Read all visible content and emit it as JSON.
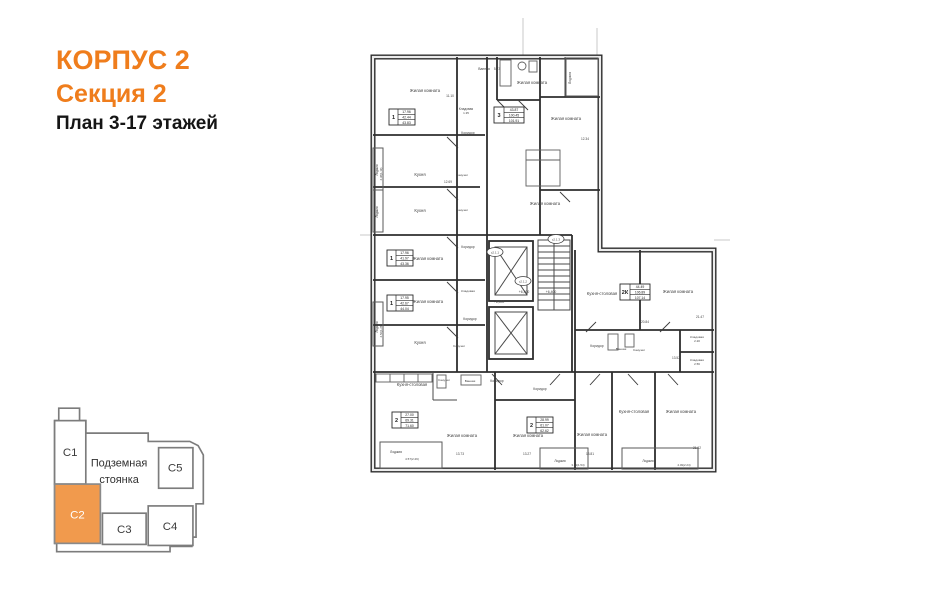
{
  "header": {
    "line1": "КОРПУС 2",
    "line2": "Секция 2",
    "line3": "План 3-17 этажей"
  },
  "colors": {
    "accent_orange": "#EF7D1C",
    "minimap_highlight": "#F19A4D",
    "plan_ink": "#2e2e2e",
    "label_ink": "#3f3f3f"
  },
  "minimap": {
    "parking_line1": "Подземная",
    "parking_line2": "стоянка",
    "highlighted_section": "С2",
    "sections": [
      {
        "label": "С1"
      },
      {
        "label": "С2"
      },
      {
        "label": "С3"
      },
      {
        "label": "С4"
      },
      {
        "label": "С5"
      }
    ]
  },
  "floor_plan": {
    "level_marks": [
      "+6,400",
      "+6,400",
      "+6,400"
    ],
    "stair_tags": [
      "с2.1.1",
      "с2.1.2",
      "с2.1.3"
    ],
    "apartments": [
      {
        "num": "1",
        "values": [
          "17.96",
          "42.44",
          "43.83"
        ],
        "x": 389,
        "y": 109
      },
      {
        "num": "3",
        "values": [
          "43.87",
          "100.45",
          "101.91"
        ],
        "x": 494,
        "y": 107
      },
      {
        "num": "1",
        "values": [
          "17.96",
          "41.97",
          "43.36"
        ],
        "x": 387,
        "y": 250
      },
      {
        "num": "1",
        "values": [
          "17.95",
          "42.67",
          "44.04"
        ],
        "x": 387,
        "y": 295
      },
      {
        "num": "2",
        "values": [
          "27.00",
          "69.31",
          "71.60"
        ],
        "x": 392,
        "y": 412
      },
      {
        "num": "2",
        "values": [
          "28.99",
          "61.07",
          "62.62"
        ],
        "x": 527,
        "y": 417
      },
      {
        "num": "2К",
        "values": [
          "44.49",
          "106.89",
          "107.14"
        ],
        "x": 620,
        "y": 284
      }
    ],
    "labels": [
      {
        "t": "Жилая комната",
        "x": 425,
        "y": 92
      },
      {
        "t": "11.10",
        "x": 450,
        "y": 97,
        "s": 3.2
      },
      {
        "t": "Ванная",
        "x": 484,
        "y": 70,
        "s": 3.4
      },
      {
        "t": "5.73",
        "x": 497,
        "y": 70,
        "s": 3.2
      },
      {
        "t": "Жилая комната",
        "x": 532,
        "y": 84
      },
      {
        "t": "Лоджия",
        "x": 571,
        "y": 78,
        "r": -90,
        "s": 3.4
      },
      {
        "t": "Жилая комната",
        "x": 566,
        "y": 120
      },
      {
        "t": "12.34",
        "x": 585,
        "y": 140,
        "s": 3.2
      },
      {
        "t": "Кладовая",
        "x": 466,
        "y": 110,
        "s": 3.2
      },
      {
        "t": "1.35",
        "x": 466,
        "y": 114,
        "s": 3
      },
      {
        "t": "Коридор",
        "x": 468,
        "y": 134,
        "s": 3.4
      },
      {
        "t": "Кухня",
        "x": 420,
        "y": 176
      },
      {
        "t": "12.69",
        "x": 448,
        "y": 183,
        "s": 3.2
      },
      {
        "t": "Санузел",
        "x": 462,
        "y": 176,
        "s": 3.1
      },
      {
        "t": "Кухня",
        "x": 420,
        "y": 212
      },
      {
        "t": "Санузел",
        "x": 462,
        "y": 211,
        "s": 3.1
      },
      {
        "t": "Лоджия",
        "x": 378,
        "y": 170,
        "r": -90,
        "s": 3.2
      },
      {
        "t": "2.38(1.19)",
        "x": 382,
        "y": 174,
        "r": -90,
        "s": 2.8
      },
      {
        "t": "Лоджия",
        "x": 378,
        "y": 212,
        "r": -90,
        "s": 3.2
      },
      {
        "t": "Жилая комната",
        "x": 428,
        "y": 260
      },
      {
        "t": "Коридор",
        "x": 468,
        "y": 248,
        "s": 3.4
      },
      {
        "t": "Кладовая",
        "x": 468,
        "y": 292,
        "s": 3.1
      },
      {
        "t": "Жилая комната",
        "x": 428,
        "y": 303
      },
      {
        "t": "Коридор",
        "x": 470,
        "y": 320,
        "s": 3.4
      },
      {
        "t": "Кухня",
        "x": 420,
        "y": 344
      },
      {
        "t": "Санузел",
        "x": 459,
        "y": 347,
        "s": 3.1
      },
      {
        "t": "Лоджия",
        "x": 378,
        "y": 327,
        "r": -90,
        "s": 3.2
      },
      {
        "t": "2.56(1.28)",
        "x": 382,
        "y": 331,
        "r": -90,
        "s": 2.8
      },
      {
        "t": "Жилая комната",
        "x": 545,
        "y": 205
      },
      {
        "t": "Кухня-столовая",
        "x": 412,
        "y": 386
      },
      {
        "t": "Санузел",
        "x": 444,
        "y": 381,
        "s": 3.1
      },
      {
        "t": "Ванная",
        "x": 470,
        "y": 382,
        "s": 3.1
      },
      {
        "t": "Коридор",
        "x": 497,
        "y": 382,
        "s": 3.4
      },
      {
        "t": "Коридор",
        "x": 540,
        "y": 390,
        "s": 3.4
      },
      {
        "t": "Жилая комната",
        "x": 462,
        "y": 437
      },
      {
        "t": "13.73",
        "x": 460,
        "y": 455,
        "s": 3.2
      },
      {
        "t": "Жилая комната",
        "x": 528,
        "y": 437
      },
      {
        "t": "13.27",
        "x": 527,
        "y": 455,
        "s": 3.2
      },
      {
        "t": "Лоджия",
        "x": 396,
        "y": 453,
        "s": 3.4
      },
      {
        "t": "4.57(2.29)",
        "x": 412,
        "y": 460,
        "s": 3
      },
      {
        "t": "Жилая комната",
        "x": 592,
        "y": 436
      },
      {
        "t": "13.81",
        "x": 590,
        "y": 455,
        "s": 3.2
      },
      {
        "t": "Кухня-столовая",
        "x": 634,
        "y": 413
      },
      {
        "t": "Жилая комната",
        "x": 681,
        "y": 413
      },
      {
        "t": "21.02",
        "x": 697,
        "y": 449,
        "s": 3.2
      },
      {
        "t": "Лоджия",
        "x": 560,
        "y": 462,
        "s": 3.2
      },
      {
        "t": "3.09(1.54)",
        "x": 578,
        "y": 466,
        "s": 2.9
      },
      {
        "t": "Лоджия",
        "x": 648,
        "y": 462,
        "s": 3.2
      },
      {
        "t": "4.49(2.24)",
        "x": 684,
        "y": 466,
        "s": 2.9
      },
      {
        "t": "Кухня-столовая",
        "x": 602,
        "y": 295
      },
      {
        "t": "Жилая комната",
        "x": 678,
        "y": 293
      },
      {
        "t": "20.84",
        "x": 645,
        "y": 323,
        "s": 3.2
      },
      {
        "t": "21.47",
        "x": 700,
        "y": 318,
        "s": 3.2
      },
      {
        "t": "Коридор",
        "x": 597,
        "y": 347,
        "s": 3.4
      },
      {
        "t": "Ванная",
        "x": 621,
        "y": 350,
        "s": 3.1
      },
      {
        "t": "Санузел",
        "x": 639,
        "y": 351,
        "s": 3.1
      },
      {
        "t": "Кладовая",
        "x": 697,
        "y": 338,
        "s": 3.1
      },
      {
        "t": "2.20",
        "x": 697,
        "y": 342,
        "s": 3
      },
      {
        "t": "Кладовая",
        "x": 697,
        "y": 361,
        "s": 3.1
      },
      {
        "t": "2.56",
        "x": 697,
        "y": 365,
        "s": 3
      },
      {
        "t": "13.52",
        "x": 676,
        "y": 359,
        "s": 3.2
      },
      {
        "t": "+6,400",
        "x": 499,
        "y": 303,
        "s": 3.4
      },
      {
        "t": "+6,400",
        "x": 524,
        "y": 293,
        "s": 3.4
      },
      {
        "t": "+6,400",
        "x": 551,
        "y": 293,
        "s": 3.4
      }
    ],
    "tags": [
      {
        "t": "с2.1.1",
        "x": 495,
        "y": 252
      },
      {
        "t": "с2.1.2",
        "x": 523,
        "y": 281
      },
      {
        "t": "с2.1.3",
        "x": 556,
        "y": 239
      }
    ]
  }
}
